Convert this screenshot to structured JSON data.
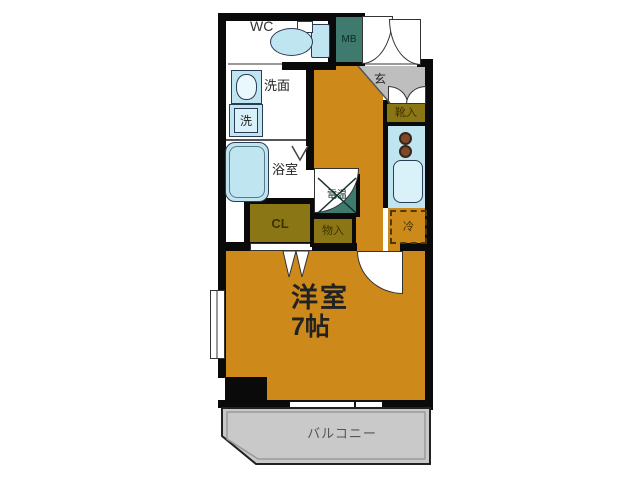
{
  "title": "apartment-floor-plan",
  "labels": {
    "wc": "WC",
    "meter_box": "MB",
    "washbasin": "洗面",
    "washer": "洗",
    "bathroom": "浴室",
    "closet": "CL",
    "water_heater": "電温",
    "storage": "物入",
    "entrance": "玄",
    "shoe_box": "靴入",
    "fridge": "冷",
    "main_room_name": "洋室",
    "main_room_size": "7帖",
    "balcony": "バルコニー"
  },
  "colors": {
    "wall": "#0A0A0A",
    "floor": "#CE891B",
    "storage_olive": "#8A7614",
    "utility_teal": "#3E7A6E",
    "fixture_blue": "#BFE5F0",
    "fixture_blue_light": "#D9F1F8",
    "fixture_line": "#2B3A55",
    "genkan_gray": "#BEBEBE",
    "balcony_gray": "#C9C9C9",
    "room_text": "#4A3208",
    "storage_text": "#3E3300",
    "teal_text": "#0E2B24"
  }
}
